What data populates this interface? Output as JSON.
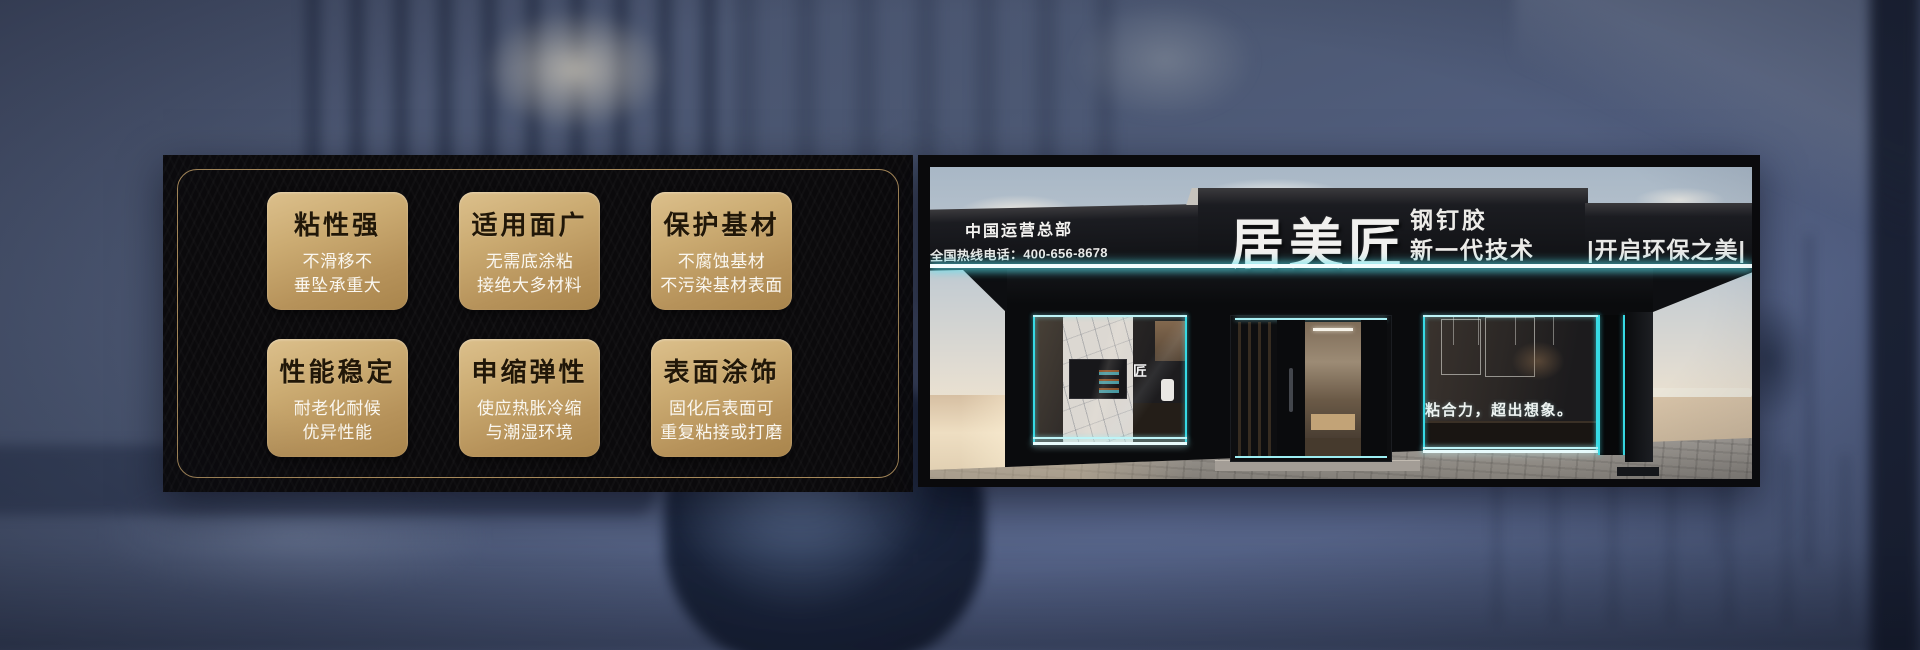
{
  "left_panel": {
    "cards": [
      {
        "title": "粘性强",
        "line1": "不滑移不",
        "line2": "垂坠承重大"
      },
      {
        "title": "适用面广",
        "line1": "无需底涂粘",
        "line2": "接绝大多材料"
      },
      {
        "title": "保护基材",
        "line1": "不腐蚀基材",
        "line2": "不污染基材表面"
      },
      {
        "title": "性能稳定",
        "line1": "耐老化耐候",
        "line2": "优异性能"
      },
      {
        "title": "申缩弹性",
        "line1": "使应热胀冷缩",
        "line2": "与潮湿环境"
      },
      {
        "title": "表面涂饰",
        "line1": "固化后表面可",
        "line2": "重复粘接或打磨"
      }
    ]
  },
  "storefront": {
    "hq_label": "中国运营总部",
    "hotline_label": "全国热线电话：400-656-8678",
    "brand_name": "居美匠",
    "product_line1": "钢钉胶",
    "product_line2": "新一代技术",
    "eco_slogan": "|开启环保之美|",
    "window_slogan": "粘合力，超出想象。",
    "glass_logo": "匠"
  },
  "colors": {
    "accent_cyan": "#3fe0ea",
    "gold_border": "#a7895a",
    "card_gold_light": "#dcc08c",
    "card_gold_dark": "#a9854c",
    "panel_black": "#0b0a0c",
    "sign_black": "#15161a",
    "background_slate": "#4c5873"
  }
}
